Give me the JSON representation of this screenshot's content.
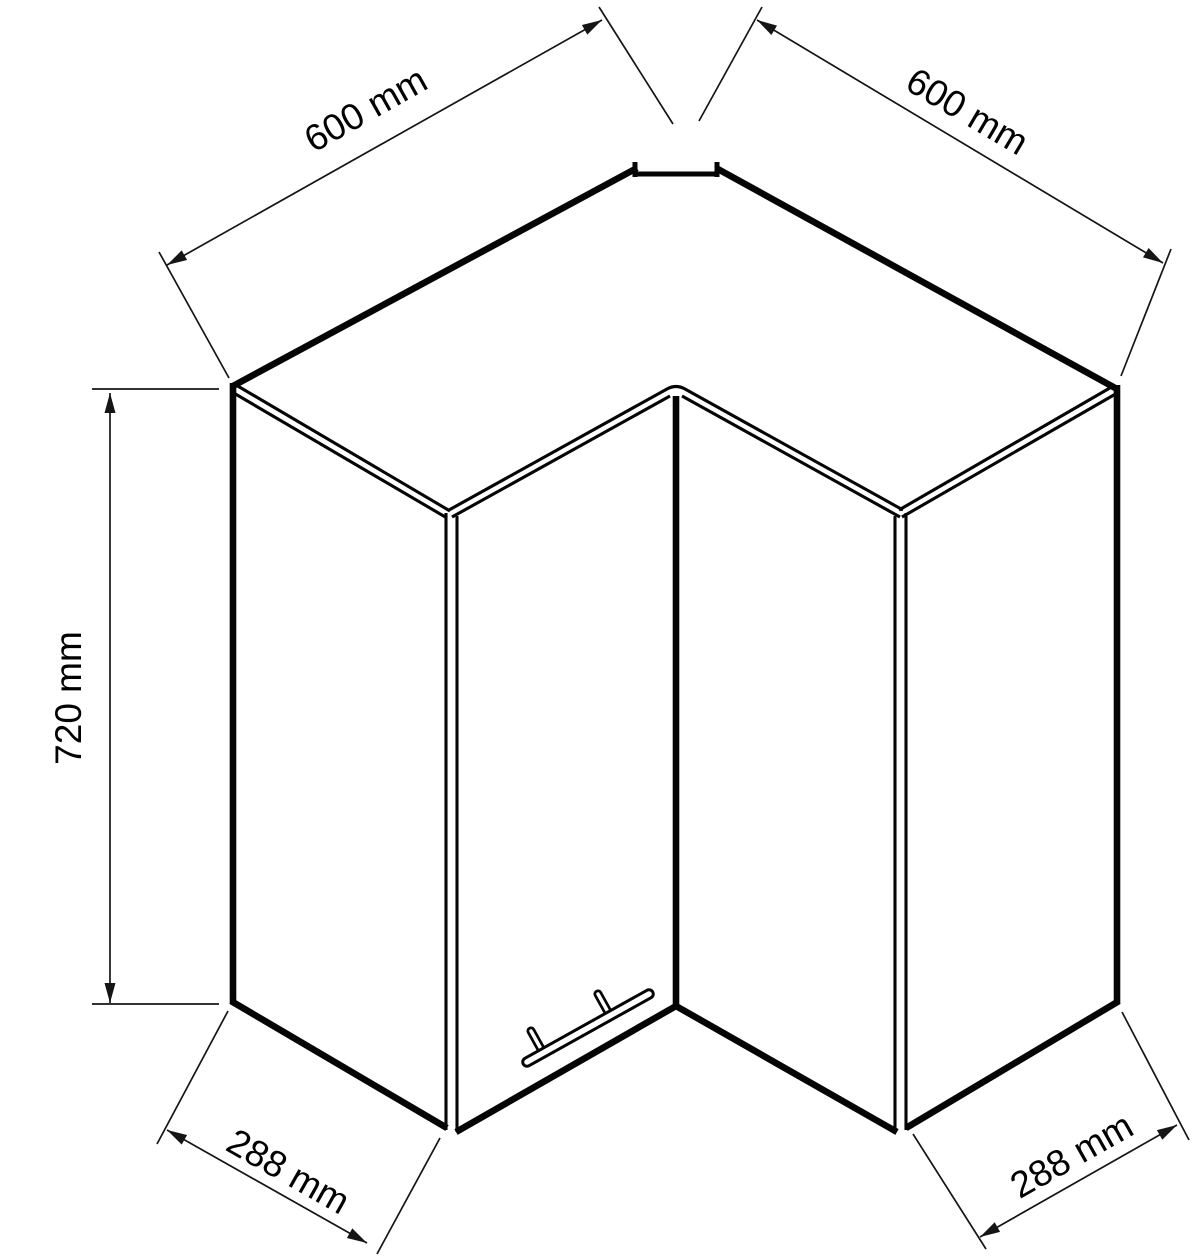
{
  "drawing": {
    "subject": "corner wall cabinet isometric line drawing",
    "line_color": "#050505",
    "background": "#ffffff",
    "dimensions": {
      "top_left": {
        "label": "600 mm",
        "value": 600,
        "unit": "mm",
        "measures": "left top edge width"
      },
      "top_right": {
        "label": "600 mm",
        "value": 600,
        "unit": "mm",
        "measures": "right top edge width"
      },
      "height": {
        "label": "720 mm",
        "value": 720,
        "unit": "mm",
        "measures": "cabinet height"
      },
      "bottom_left": {
        "label": "288 mm",
        "value": 288,
        "unit": "mm",
        "measures": "left side panel depth"
      },
      "bottom_right": {
        "label": "288 mm",
        "value": 288,
        "unit": "mm",
        "measures": "right side panel depth"
      }
    }
  }
}
